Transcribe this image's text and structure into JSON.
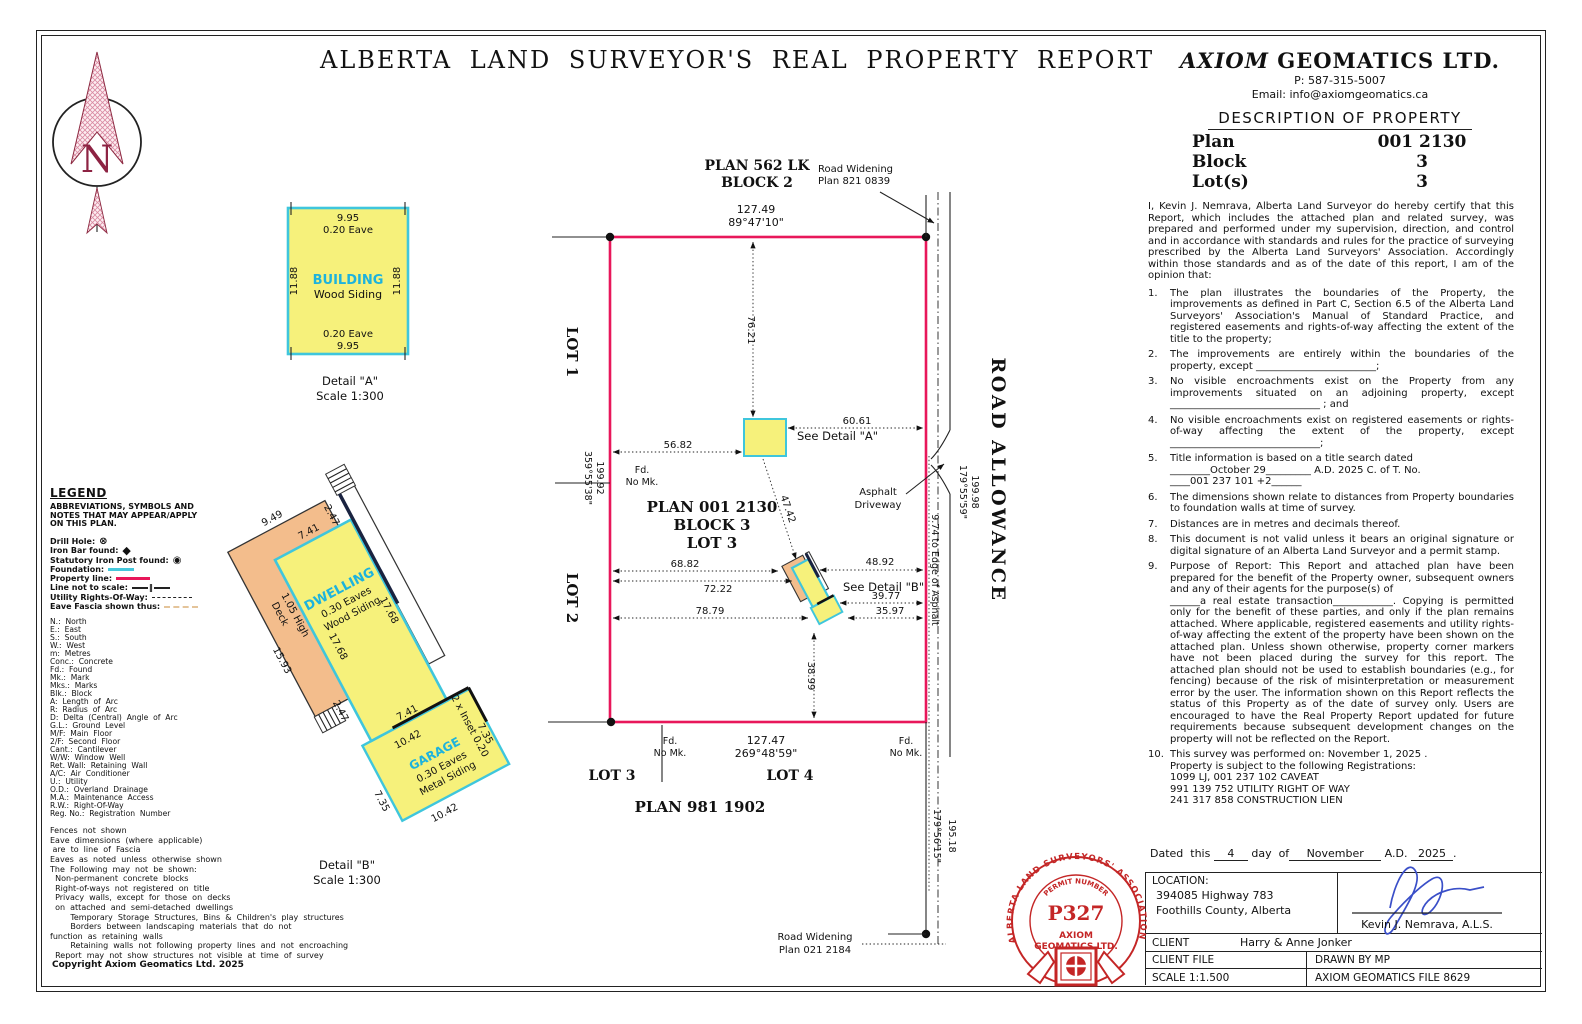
{
  "page": {
    "title": "ALBERTA  LAND  SURVEYOR'S  REAL  PROPERTY  REPORT"
  },
  "company": {
    "name_italic": "AXIOM",
    "name_rest": " GEOMATICS  LTD.",
    "phone": "P:  587-315-5007",
    "email": "Email:  info@axiomgeomatics.ca"
  },
  "description": {
    "heading": "DESCRIPTION  OF  PROPERTY",
    "rows": [
      {
        "label": "Plan",
        "value": "001  2130"
      },
      {
        "label": "Block",
        "value": "3"
      },
      {
        "label": "Lot(s)",
        "value": "3"
      }
    ]
  },
  "certification": {
    "intro": "I, Kevin J. Nemrava, Alberta Land Surveyor do hereby certify that this Report, which includes the attached plan and related survey, was prepared and performed under my supervision, direction, and control and in accordance with standards and rules for the practice of surveying prescribed by the Alberta Land Surveyors' Association. Accordingly within those standards and as of the date of this report, I am of the opinion that:",
    "nums": [
      "1.",
      "2.",
      "3.",
      "4.",
      "5.",
      "6.",
      "7.",
      "8.",
      "9.",
      "10."
    ],
    "items": [
      "The plan illustrates the boundaries of the Property, the improvements as defined in Part C, Section 6.5 of the Alberta Land Surveyors' Association's Manual of Standard Practice, and registered easements and rights-of-way affecting the extent of the title to the property;",
      "The improvements are entirely within the boundaries of the property, except ________________________;",
      "No visible encroachments exist on the Property from any improvements situated on an adjoining property, except ______________________________ ; and",
      "No visible encroachments exist on registered easements or rights-of-way affecting the extent of the property, except ______________________________;",
      "Title information is based on a title search dated\n________October 29_________  A.D. 2025  C. of T. No.\n____001 237 101 +2______",
      "The dimensions shown relate to distances from Property boundaries to foundation walls at time of survey.",
      "Distances are in metres and decimals thereof.",
      "This document is not valid unless it bears an original signature or digital signature of an Alberta Land Surveyor and a permit stamp.",
      "Purpose of Report: This Report and attached plan have been prepared for the benefit of the Property owner, subsequent owners and any of their agents for the purpose(s) of\n______a real estate transaction____________. Copying is permitted only for the benefit of these parties, and only if the plan remains attached. Where applicable, registered easements and utility rights-of-way affecting the extent of the property have been shown on the attached plan. Unless shown otherwise, property corner markers have not been placed during the survey for this report. The attached plan should not be used to establish boundaries (e.g., for fencing) because of the risk of misinterpretation or measurement error by the user. The information shown on this Report reflects the status of this Property as of the date of survey only. Users are encouraged to have the Real Property Report updated for future requirements because subsequent development changes on the property will not be reflected on the Report.",
      "This survey was performed on:  November 1, 2025 .\nProperty is subject to the following Registrations:\n1099 LJ, 001 237 102 CAVEAT\n991 139 752 UTILITY RIGHT OF WAY\n241 317 858 CONSTRUCTION LIEN"
    ]
  },
  "legend": {
    "heading": "LEGEND",
    "sub": "ABBREVIATIONS, SYMBOLS AND\nNOTES THAT MAY APPEAR/APPLY\nON THIS PLAN.",
    "symbols": [
      {
        "label": "Drill Hole:"
      },
      {
        "label": "Iron Bar found:"
      },
      {
        "label": "Statutory Iron Post found:"
      },
      {
        "label": "Foundation:"
      },
      {
        "label": "Property line:"
      },
      {
        "label": "Line not to scale:"
      },
      {
        "label": "Utility Rights-Of-Way:"
      },
      {
        "label": "Eave Fascia shown thus:"
      }
    ],
    "abbreviations": [
      "N.:  North",
      "E.:  East",
      "S.:  South",
      "W.:  West",
      "m:  Metres",
      "Conc.:  Concrete",
      "Fd.:  Found",
      "Mk.:  Mark",
      "Mks.:  Marks",
      "Blk.:  Block",
      "A:  Length  of  Arc",
      "R:  Radius  of  Arc",
      "D:  Delta  (Central)  Angle  of  Arc",
      "G.L.:  Ground  Level",
      "M/F:  Main  Floor",
      "2/F:  Second  Floor",
      "Cant.:  Cantilever",
      "W/W:  Window  Well",
      "Ret. Wall:  Retaining  Wall",
      "A/C:  Air  Conditioner",
      "U.:  Utility",
      "O.D.:  Overland  Drainage",
      "M.A.:  Maintenance  Access",
      "R.W.:  Right-Of-Way",
      "Reg. No.:  Registration  Number"
    ],
    "notes": [
      "Fences  not  shown",
      "Eave  dimensions  (where  applicable)",
      " are  to  line  of  Fascia",
      "Eaves  as  noted  unless  otherwise  shown",
      "The  Following  may  not  be  shown:",
      "  Non-permanent  concrete  blocks",
      "  Right-of-ways  not  registered  on  title",
      "  Privacy  walls,  except  for  those  on  decks",
      "  on  attached  and  semi-detached  dwellings",
      "        Temporary  Storage  Structures,  Bins  &  Children's  play  structures",
      "        Borders  between  landscaping  materials  that  do  not",
      "function  as  retaining  walls",
      "        Retaining  walls  not  following  property  lines  and  not  encroaching",
      "  Report  may  not  show  structures  not  visible  at  time  of  survey"
    ],
    "copyright": "Copyright  Axiom  Geomatics  Ltd.  2025"
  },
  "plan": {
    "block2_1": "PLAN  562  LK",
    "block2_2": "BLOCK  2",
    "dim_top_len": "127.49",
    "dim_top_brg": "89°47'10\"",
    "rw_top_1": "Road  Widening",
    "rw_top_2": "Plan  821  0839",
    "lot1": "LOT  1",
    "lot2": "LOT  2",
    "west_len": "199.92",
    "west_brg": "359°55'38\"",
    "fd": "Fd.",
    "no_mk": "No Mk.",
    "parcel_1": "PLAN  001  2130",
    "parcel_2": "BLOCK  3",
    "parcel_3": "LOT  3",
    "d76": "76.21",
    "d60": "60.61",
    "d56": "56.82",
    "d47": "47.42",
    "d68": "68.82",
    "d72": "72.22",
    "d48": "48.92",
    "d39": "39.77",
    "d78": "78.79",
    "d35": "35.97",
    "d38": "38.99",
    "see_a": "See  Detail  \"A\"",
    "see_b": "See  Detail  \"B\"",
    "asphalt_1": "Asphalt",
    "asphalt_2": "Driveway",
    "road_allowance": "ROAD  ALLOWANCE",
    "east_len": "199.98",
    "east_brg": "179°55'59\"",
    "edge": "9.74  to  Edge  of  Asphalt",
    "dim_bot_len": "127.47",
    "dim_bot_brg": "269°48'59\"",
    "lot3": "LOT  3",
    "lot4": "LOT  4",
    "plan_south": "PLAN  981  1902",
    "rw_bot_1": "Road  Widening",
    "rw_bot_2": "Plan  021  2184",
    "east2_len": "195.18",
    "east2_brg": "179°56'15\""
  },
  "detail_a": {
    "len_top": "9.95",
    "eave_top": "0.20  Eave",
    "side_left": "11.88",
    "side_right": "11.88",
    "name": "BUILDING",
    "siding": "Wood  Siding",
    "eave_bot": "0.20  Eave",
    "len_bot": "9.95",
    "caption": "Detail  \"A\"",
    "scale": "Scale  1:300"
  },
  "detail_b": {
    "caption": "Detail  \"B\"",
    "scale": "Scale  1:300",
    "deck_1": "Deck",
    "deck_2": "1.05 High",
    "deck_w": "9.49",
    "deck_l": "15.93",
    "deck_off_top": "2.47",
    "deck_off_bot": "2.47",
    "dw_w_top": "7.41",
    "dw_w_bot": "7.41",
    "dw_l_left": "17.68",
    "dw_l_right": "17.68",
    "name": "DWELLING",
    "eaves": "0.30  Eaves",
    "siding": "Wood  Siding",
    "g_name": "GARAGE",
    "g_eaves": "0.30  Eaves",
    "g_siding": "Metal  Siding",
    "g_w_top": "10.42",
    "g_w_bot": "10.42",
    "g_l_left": "7.35",
    "g_l_right": "7.35",
    "inset": "2  x  Inset  0.20"
  },
  "stamp": {
    "ring": "ALBERTA LAND SURVEYORS' ASSOCIATION",
    "permit_label": "PERMIT  NUMBER",
    "permit": "P327",
    "co_1": "AXIOM",
    "co_2": "GEOMATICS  LTD."
  },
  "footer": {
    "dated_pre": "Dated  this",
    "day": "4",
    "dated_mid": "day  of",
    "month": "November",
    "ad": " A.D. ",
    "year": "2025",
    "period": ".",
    "location_label": "LOCATION:",
    "loc1": "394085  Highway  783",
    "loc2": "Foothills  County,  Alberta",
    "surveyor": "Kevin  J.  Nemrava,  A.L.S.",
    "client_label": "CLIENT",
    "client": "Harry  &  Anne  Jonker",
    "client_file": "CLIENT  FILE",
    "drawn": "DRAWN  BY    MP",
    "scale": "SCALE  1:1.500",
    "file": "AXIOM  GEOMATICS  FILE  8629"
  }
}
